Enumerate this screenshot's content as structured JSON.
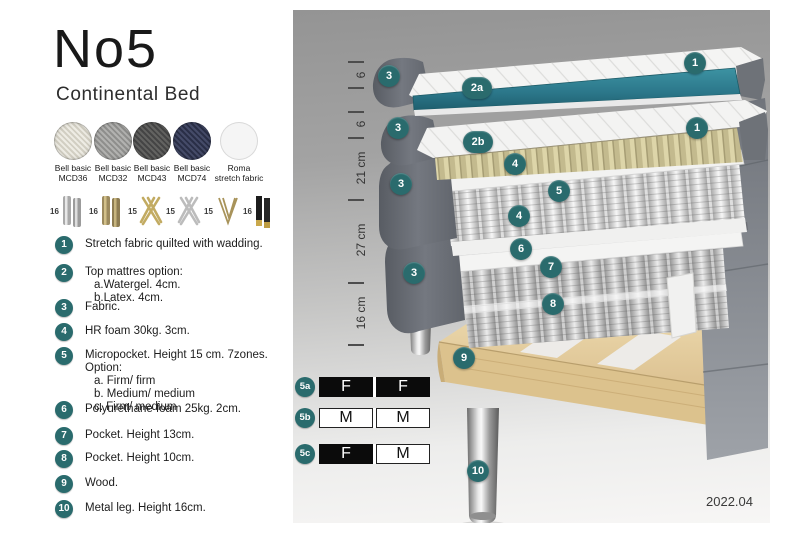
{
  "header": {
    "title": "No5",
    "subtitle": "Continental Bed"
  },
  "colors": {
    "accent_teal": "#2a6b6d",
    "topper_teal": "#2e7b8b",
    "fabric_gray": "#6e7278",
    "latex_tan": "#ddd5a9",
    "wood": "#e7d3a4",
    "swatch_mcd36": "#e9e6dd",
    "swatch_mcd32": "#a9a9a7",
    "swatch_mcd43": "#575755",
    "swatch_mcd74": "#3a4059",
    "swatch_roma": "#f5f5f5"
  },
  "swatches": [
    {
      "line1": "Bell basic",
      "line2": "MCD36"
    },
    {
      "line1": "Bell basic",
      "line2": "MCD32"
    },
    {
      "line1": "Bell basic",
      "line2": "MCD43"
    },
    {
      "line1": "Bell basic",
      "line2": "MCD74"
    },
    {
      "line1": "Roma",
      "line2": "stretch fabric"
    }
  ],
  "legs": [
    {
      "height": "16",
      "style": "cylinder-silver"
    },
    {
      "height": "16",
      "style": "cylinder-brass"
    },
    {
      "height": "15",
      "style": "cross-gold"
    },
    {
      "height": "15",
      "style": "cross-silver"
    },
    {
      "height": "15",
      "style": "hairpin-brass"
    },
    {
      "height": "16",
      "style": "cylinder-black-brass-tip"
    }
  ],
  "spec_list": [
    {
      "num": "1",
      "lines": [
        "Stretch fabric quilted with wadding."
      ]
    },
    {
      "num": "2",
      "lines": [
        "Top mattres option:",
        "a.Watergel. 4cm.",
        "b.Latex. 4cm."
      ]
    },
    {
      "num": "3",
      "lines": [
        "Fabric."
      ]
    },
    {
      "num": "4",
      "lines": [
        "HR foam 30kg. 3cm."
      ]
    },
    {
      "num": "5",
      "lines": [
        "Micropocket. Height 15 cm. 7zones. Option:",
        "a. Firm/ firm",
        "b. Medium/ medium",
        "c. Firm/ medium"
      ]
    },
    {
      "num": "6",
      "lines": [
        "Polyurethane foam 25kg. 2cm."
      ]
    },
    {
      "num": "7",
      "lines": [
        "Pocket. Height 13cm."
      ]
    },
    {
      "num": "8",
      "lines": [
        "Pocket. Height 10cm."
      ]
    },
    {
      "num": "9",
      "lines": [
        "Wood."
      ]
    },
    {
      "num": "10",
      "lines": [
        "Metal leg. Height 16cm."
      ]
    }
  ],
  "diagram": {
    "measurements": [
      {
        "label": "6"
      },
      {
        "label": "6"
      },
      {
        "label": "21 cm"
      },
      {
        "label": "27 cm"
      },
      {
        "label": "16 cm"
      }
    ],
    "callouts": [
      {
        "label": "3"
      },
      {
        "label": "2a"
      },
      {
        "label": "1"
      },
      {
        "label": "3"
      },
      {
        "label": "2b"
      },
      {
        "label": "1"
      },
      {
        "label": "4"
      },
      {
        "label": "5"
      },
      {
        "label": "3"
      },
      {
        "label": "4"
      },
      {
        "label": "6"
      },
      {
        "label": "7"
      },
      {
        "label": "3"
      },
      {
        "label": "8"
      },
      {
        "label": "9"
      },
      {
        "label": "10"
      }
    ],
    "firmness": [
      {
        "label": "5a",
        "cells": [
          {
            "text": "F"
          },
          {
            "text": "F"
          }
        ]
      },
      {
        "label": "5b",
        "cells": [
          {
            "text": "M"
          },
          {
            "text": "M"
          }
        ]
      },
      {
        "label": "5c",
        "cells": [
          {
            "text": "F"
          },
          {
            "text": "M"
          }
        ]
      }
    ],
    "version": "2022.04"
  }
}
